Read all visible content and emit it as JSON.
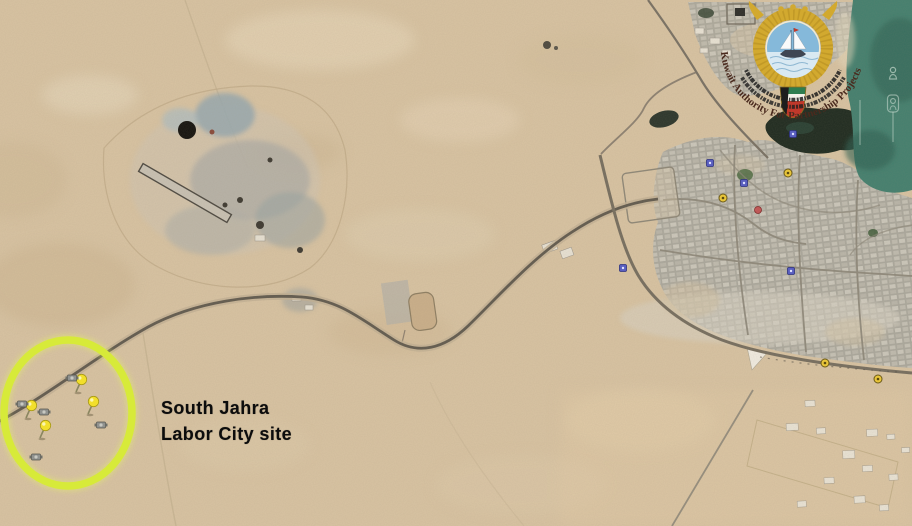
{
  "window": {
    "width": 912,
    "height": 526,
    "view": "satellite-map"
  },
  "annotation": {
    "label_line1": "South Jahra",
    "label_line2": "Labor City site",
    "site_circle": {
      "cx": 68,
      "cy": 413,
      "rx": 64,
      "ry": 73,
      "color": "#d7ea39"
    }
  },
  "logo": {
    "curved_text": "Kuwait Authority For Partnership Projects",
    "emblem_icon": "kuwait-coat-of-arms-falcon-dhow",
    "arabic_band_icon": "arabic-calligraphy-band",
    "colors": {
      "gold": "#d2a92f",
      "flag_green": "#2e7d4f",
      "flag_white": "#f4f2ea",
      "flag_red": "#c0392b",
      "flag_black": "#1d1d1d",
      "text": "#4a2a1e"
    }
  },
  "terrain_colors": {
    "desert_base": "#d9c4a3",
    "water": "#44806f",
    "city_blocks": "#aca99e",
    "road_dark": "#635c50",
    "vegetation_dark": "#1f2b20",
    "site_circle": "#d7ea39",
    "pushpin_yellow": "#f2df2c"
  },
  "markers": [
    {
      "icon": "pushpin-icon",
      "x": 76,
      "y": 392
    },
    {
      "icon": "pushpin-icon",
      "x": 26,
      "y": 418
    },
    {
      "icon": "pushpin-icon",
      "x": 88,
      "y": 414
    },
    {
      "icon": "pushpin-icon",
      "x": 40,
      "y": 438
    },
    {
      "icon": "equipment-icon",
      "x": 72,
      "y": 378
    },
    {
      "icon": "equipment-icon",
      "x": 22,
      "y": 404
    },
    {
      "icon": "equipment-icon",
      "x": 44,
      "y": 412
    },
    {
      "icon": "equipment-icon",
      "x": 101,
      "y": 425
    },
    {
      "icon": "equipment-icon",
      "x": 36,
      "y": 457
    },
    {
      "icon": "poi-yellow-icon",
      "x": 723,
      "y": 198
    },
    {
      "icon": "poi-yellow-icon",
      "x": 788,
      "y": 173
    },
    {
      "icon": "poi-yellow-icon",
      "x": 825,
      "y": 363
    },
    {
      "icon": "poi-yellow-icon",
      "x": 878,
      "y": 379
    },
    {
      "icon": "poi-blue-icon",
      "x": 744,
      "y": 183
    },
    {
      "icon": "poi-blue-icon",
      "x": 710,
      "y": 163
    },
    {
      "icon": "poi-blue-icon",
      "x": 623,
      "y": 268
    },
    {
      "icon": "poi-blue-icon",
      "x": 791,
      "y": 271
    },
    {
      "icon": "poi-blue-icon",
      "x": 793,
      "y": 134
    },
    {
      "icon": "poi-red-icon",
      "x": 758,
      "y": 210
    },
    {
      "icon": "ghost-placemark-icon",
      "x": 893,
      "y": 75
    },
    {
      "icon": "ghost-framed-placemark-icon",
      "x": 893,
      "y": 105
    }
  ]
}
